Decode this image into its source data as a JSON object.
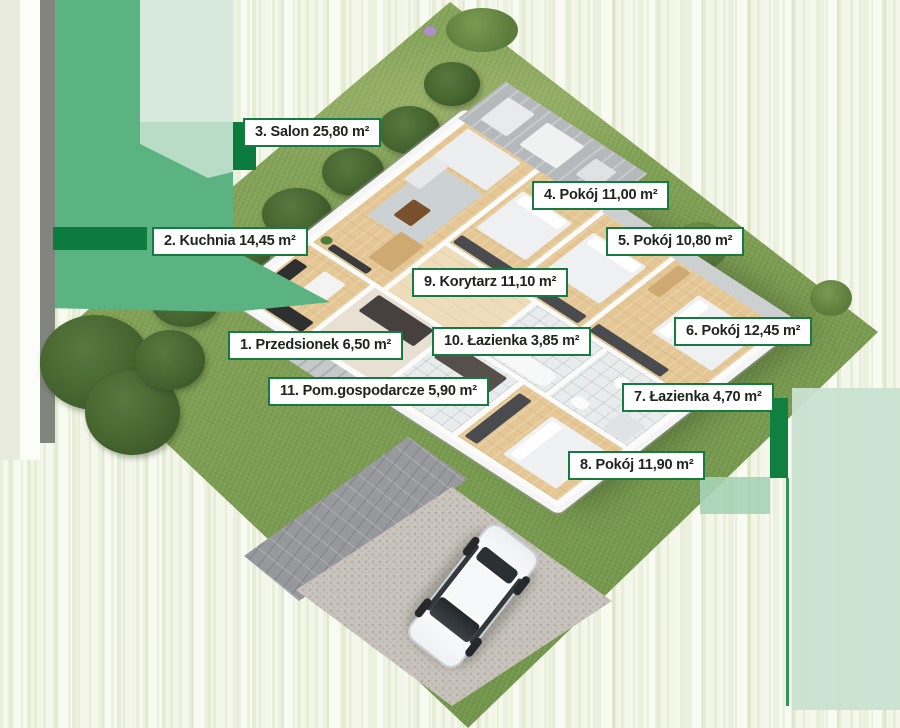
{
  "scene": {
    "description": "3D isometric floor plan of a single-storey house on a green lot with driveway and white car",
    "area_unit": "m²"
  },
  "colors": {
    "label_border": "#177a43",
    "label_background": "#ffffff",
    "label_text": "#20241f",
    "grass": "#7fa054",
    "overlay_green": "#5ab380",
    "overlay_dark_green": "#0b7c3e",
    "overlay_mint": "#d7e8dc",
    "pavement": "#9d9fa2",
    "gravel": "#cdc8c2",
    "wood_floor": "#e4c795",
    "car": "#ffffff"
  },
  "rooms": [
    {
      "number": "1",
      "name": "Przedsionek",
      "area": "6,50 m²",
      "label": "1. Przedsionek 6,50 m²"
    },
    {
      "number": "2",
      "name": "Kuchnia",
      "area": "14,45 m²",
      "label": "2. Kuchnia 14,45 m²"
    },
    {
      "number": "3",
      "name": "Salon",
      "area": "25,80 m²",
      "label": "3. Salon 25,80 m²"
    },
    {
      "number": "4",
      "name": "Pokój",
      "area": "11,00 m²",
      "label": "4. Pokój 11,00 m²"
    },
    {
      "number": "5",
      "name": "Pokój",
      "area": "10,80 m²",
      "label": "5. Pokój 10,80 m²"
    },
    {
      "number": "6",
      "name": "Pokój",
      "area": "12,45 m²",
      "label": "6. Pokój 12,45 m²"
    },
    {
      "number": "7",
      "name": "Łazienka",
      "area": "4,70 m²",
      "label": "7. Łazienka 4,70 m²"
    },
    {
      "number": "8",
      "name": "Pokój",
      "area": "11,90 m²",
      "label": "8. Pokój 11,90 m²"
    },
    {
      "number": "9",
      "name": "Korytarz",
      "area": "11,10 m²",
      "label": "9. Korytarz 11,10 m²"
    },
    {
      "number": "10",
      "name": "Łazienka",
      "area": "3,85 m²",
      "label": "10. Łazienka 3,85 m²"
    },
    {
      "number": "11",
      "name": "Pom.gospodarcze",
      "area": "5,90 m²",
      "label": "11. Pom.gospodarcze 5,90 m²"
    }
  ]
}
